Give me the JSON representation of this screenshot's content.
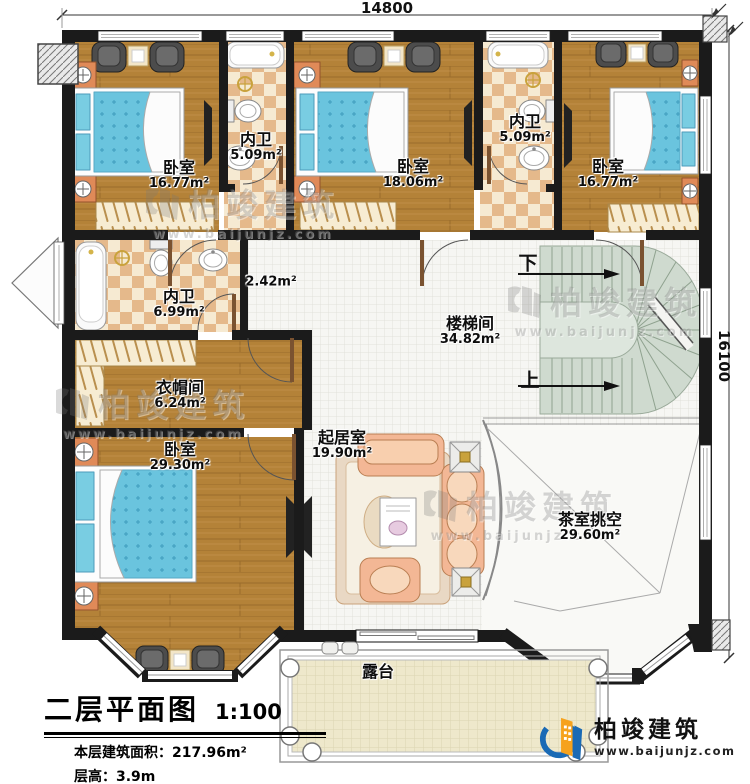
{
  "page": {
    "width": 750,
    "height": 784
  },
  "dimensions": {
    "top": "14800",
    "right": "16100"
  },
  "rooms": {
    "bedroom_top_left": {
      "name": "卧室",
      "area": "16.77m²"
    },
    "bath_top_left": {
      "name": "内卫",
      "area": "5.09m²"
    },
    "bedroom_top_mid": {
      "name": "卧室",
      "area": "18.06m²"
    },
    "bath_top_right": {
      "name": "内卫",
      "area": "5.09m²"
    },
    "bedroom_top_right": {
      "name": "卧室",
      "area": "16.77m²"
    },
    "bath_mid_left": {
      "name": "内卫",
      "area": "6.99m²"
    },
    "corridor": {
      "area": "2.42m²"
    },
    "stair_hall": {
      "name": "楼梯间",
      "area": "34.82m²"
    },
    "cloakroom": {
      "name": "衣帽间",
      "area": "6.24m²"
    },
    "bedroom_bottom_left": {
      "name": "卧室",
      "area": "29.30m²"
    },
    "living_room": {
      "name": "起居室",
      "area": "19.90m²"
    },
    "tea_room_void": {
      "name": "茶室挑空",
      "area": "29.60m²"
    },
    "terrace": {
      "name": "露台"
    }
  },
  "stairs": {
    "down_label": "下",
    "up_label": "上"
  },
  "title_block": {
    "title": "二层平面图",
    "scale": "1:100",
    "area_label": "本层建筑面积：",
    "area_value": "217.96m²",
    "height_label": "层高：",
    "height_value": "3.9m"
  },
  "brand": {
    "name": "柏竣建筑",
    "website": "www.baijunjz.com"
  },
  "colors": {
    "wall": "#1b1b1b",
    "wood_floor": "#b48238",
    "checker_light": "#f6ead2",
    "checker_dark": "#e5b98b",
    "stair_green": "#cfdacf",
    "bed_blue": "#6ac4de",
    "sofa_salmon": "#f3b795",
    "terrace_beige": "#eee8cb",
    "brand_blue": "#1a6ab5",
    "brand_orange": "#f6a21d"
  }
}
